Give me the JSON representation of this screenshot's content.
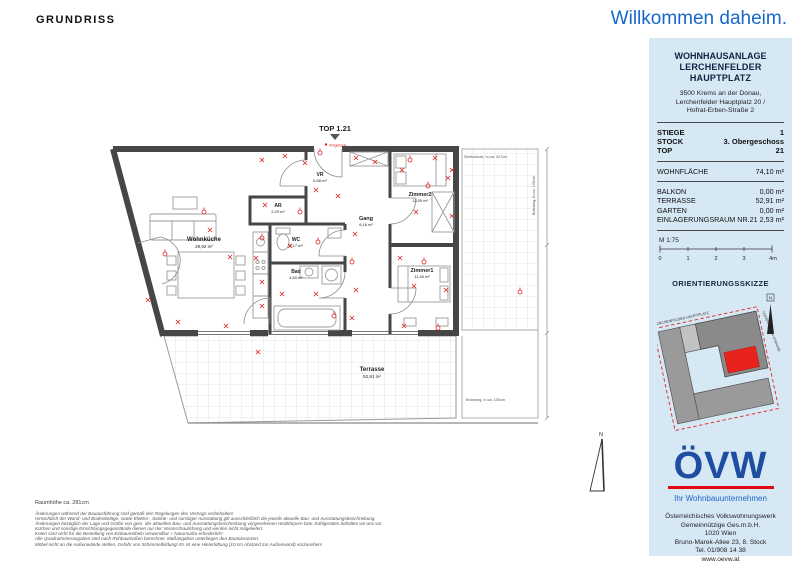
{
  "page": {
    "title_left": "GRUNDRISS",
    "welcome": "Willkommen daheim."
  },
  "plan": {
    "top_label": "TOP 1.21",
    "rooms": [
      {
        "name": "Wohnküche",
        "area": "29,92 m²"
      },
      {
        "name": "AR",
        "area": "2,29 m²"
      },
      {
        "name": "VR",
        "area": "6,58 m²"
      },
      {
        "name": "Gang",
        "area": "6,16 m²"
      },
      {
        "name": "WC",
        "area": "2,17 m²"
      },
      {
        "name": "Bad",
        "area": "4,60 m²"
      },
      {
        "name": "Zimmer2",
        "area": "13,09 m²"
      },
      {
        "name": "Zimmer1",
        "area": "11,40 m²"
      },
      {
        "name": "Terrasse",
        "area": "52,91 m²"
      }
    ],
    "annotations": {
      "sichtschutz": "Sichtschutz, h=ca. 207cm",
      "bruestung_right": "Brüstung, h=ca. 100cm",
      "bruestung_bottom": "Brüstung, h=ca. 100cm",
      "klingel": "Klingeltaste",
      "north": "N"
    }
  },
  "footnotes": {
    "room_height": "Raumhöhe ca. 281cm",
    "lines": [
      "Änderungen während der Bauausführung sind gemäß den Regelungen des Vertrags vorbehalten!",
      "Hinsichtlich der Wand- und Bodenbeläge, sowie Elektro-, Sanitär- und sonstiger Ausstattung gilt ausschließlich die jeweils aktuelle Bau- und Ausstattungsbeschreibung.",
      "Änderungen bezüglich der Lage und Größe von gem. der aktuellen Bau- und Ausstattungsbeschreibung vorgesehenen Heizkörpern bzw. Kühlgeräten behalten wir uns vor.",
      "Küchen und sonstige Einrichtungsgegenstände dienen nur der Veranschaulichung und werden nicht mitgeliefert.",
      "Koten sind nicht für die Bestellung von Einbaumöbeln verwendbar + Naturmaße erforderlich!",
      "Alle Quadratmeterangaben sind nach Rohbaumaßen berechnet. Maßangaben unterliegen den Bautoleranzen.",
      "Möbel nicht an die Außenwände stellen, Gefahr von Schimmelbildung! Es ist eine Hinterlüftung (10 cm Abstand zur Außenwand) vorzusehen!"
    ]
  },
  "sidebar": {
    "project": {
      "line1": "WOHNHAUSANLAGE",
      "line2": "LERCHENFELDER HAUPTPLATZ"
    },
    "address": [
      "3500 Krems an der Donau,",
      "Lerchenfelder Hauptplatz 20 /",
      "Hofrat-Erben-Straße 2"
    ],
    "unit_rows": [
      {
        "label": "STIEGE",
        "value": "1"
      },
      {
        "label": "STOCK",
        "value": "3. Obergeschoss"
      },
      {
        "label": "TOP",
        "value": "21"
      }
    ],
    "area_main": {
      "label": "WOHNFLÄCHE",
      "value": "74,10 m²"
    },
    "area_rows": [
      {
        "label": "BALKON",
        "value": "0,00 m²"
      },
      {
        "label": "TERRASSE",
        "value": "52,91 m²"
      },
      {
        "label": "GARTEN",
        "value": "0,00 m²"
      },
      {
        "label": "EINLAGERUNGSRAUM NR.21",
        "value": "2,53 m²"
      }
    ],
    "scale": {
      "label": "M 1:75",
      "ticks": [
        "0",
        "1",
        "2",
        "3",
        "4m"
      ]
    },
    "sketch": {
      "title": "ORIENTIERUNGSSKIZZE",
      "street_top": "LERCHENFELDER HAUPTPLATZ",
      "street_right": "HOFRAT-ERBEN-STRASSE",
      "north": "N"
    },
    "logo": {
      "text": "ÖVW",
      "tagline": "Ihr Wohnbauunternehmen"
    },
    "company": [
      "Österreichisches Volkswohnungswerk",
      "Gemeinnützige Ges.m.b.H.",
      "1020 Wien",
      "Bruno-Marek-Allee 23, 8. Stock",
      "Tel. 01/908 14 38",
      "www.oevw.at"
    ],
    "plan_status": {
      "label": "Planstand:",
      "value": "18.11.2025"
    }
  },
  "colors": {
    "accent_blue": "#1668c9",
    "logo_blue": "#1d4ea1",
    "logo_red": "#e30613",
    "sidebar_bg": "#d7e8f5",
    "wall_gray": "#464646",
    "electro_red": "#e02424"
  }
}
